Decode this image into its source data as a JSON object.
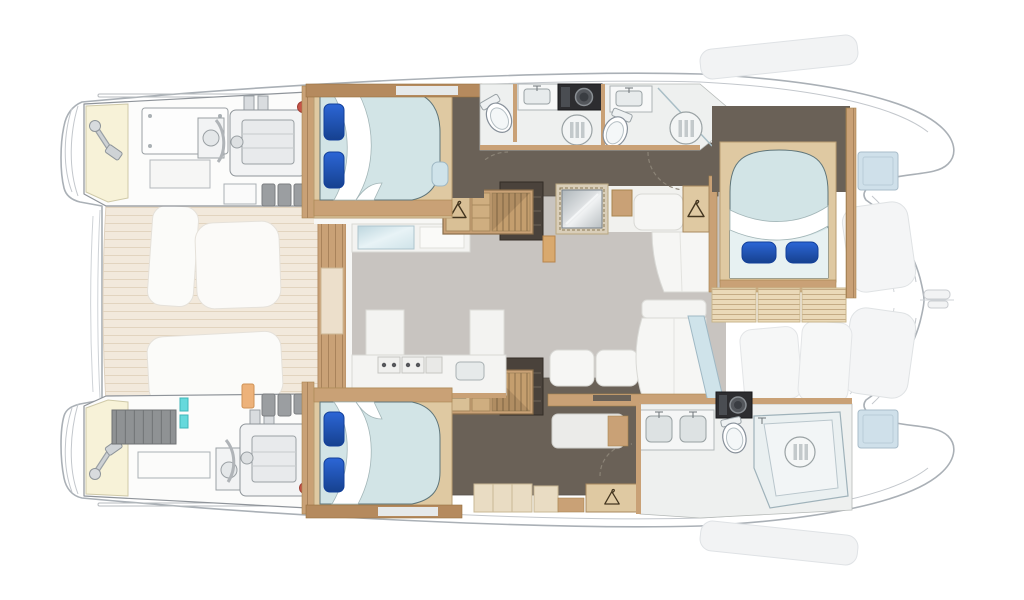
{
  "colors": {
    "page_bg": "#ffffff",
    "hull_fill": "#ffffff",
    "hull_line": "#aab0b6",
    "ghost_fill": "#f2f3f4",
    "ghost_line": "#dfe2e5",
    "hatch_blue": "#cfe0ea",
    "cockpit_teak": "#f2e9dc",
    "plank_line": "#e2d4bf",
    "wood": "#c9a176",
    "wood_dark": "#b58a5e",
    "wood_light": "#dfc9a2",
    "wood_pale": "#e9dcc3",
    "salon_floor": "#c8c4c0",
    "dark_floor": "#6a6157",
    "dark_shelf": "#4a423b",
    "bed_duvet": "#d2e4e6",
    "bed_duvet_light": "#e7f1f2",
    "pillow_blue": "#1d53c0",
    "glass_blue": "#cfe3ea",
    "bath_floor": "#eef0ef",
    "fixture_white": "#f5f6f6",
    "basin_gray": "#dde2e3",
    "washer_black": "#2d2d30",
    "cream": "#f7f2d8",
    "machinery": "#f2f3f4",
    "machinery_inner": "#e8eaec",
    "battery_gray": "#8f9294",
    "canister_gray": "#9b9ea1",
    "teal": "#66d9dc",
    "orange": "#edb27a",
    "red": "#c65449",
    "white": "#fdfdfd"
  },
  "plan": {
    "subject": "catamaran-yacht-interior-floor-plan",
    "orientation": "bow-right",
    "rooms": [
      {
        "id": "port-engine-room"
      },
      {
        "id": "starboard-engine-room"
      },
      {
        "id": "aft-cockpit"
      },
      {
        "id": "salon"
      },
      {
        "id": "galley"
      },
      {
        "id": "port-aft-cabin",
        "berth": "double"
      },
      {
        "id": "starboard-aft-cabin",
        "berth": "double"
      },
      {
        "id": "forward-starboard-cabin",
        "berth": "double"
      },
      {
        "id": "port-bathroom"
      },
      {
        "id": "port-guest-bathroom"
      },
      {
        "id": "starboard-bathroom-with-shower"
      }
    ],
    "fixture_counts": {
      "beds": 3,
      "pillows_per_bed": 2,
      "toilets": 3,
      "shower_drains": 3,
      "sinks": 4,
      "appliances_black": 2,
      "wardrobe_hangers": 4,
      "companionway_stairs": 2,
      "engines": 2,
      "sofas": 2
    }
  }
}
